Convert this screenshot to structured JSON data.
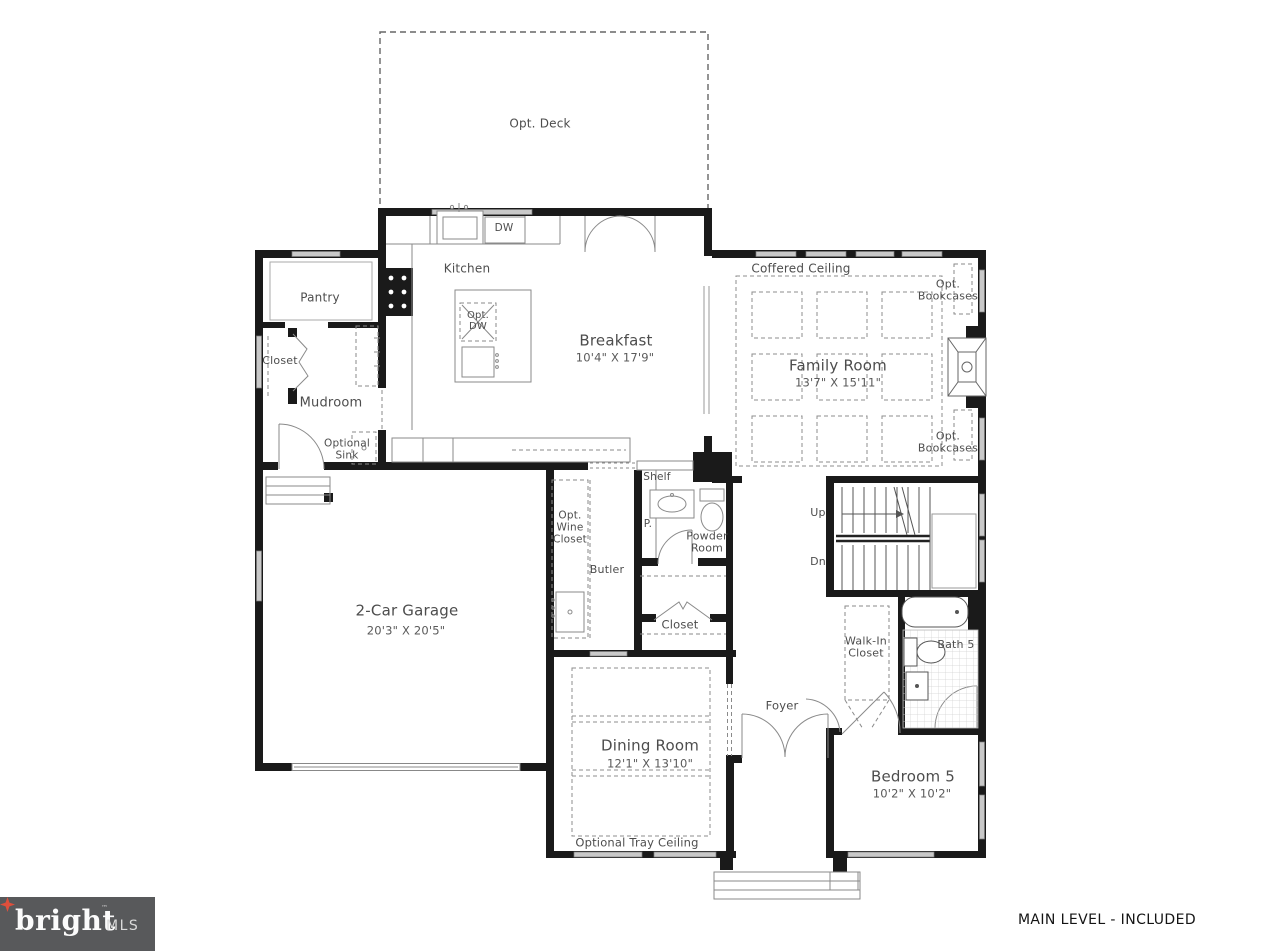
{
  "rooms": {
    "deck": {
      "label": "Opt. Deck"
    },
    "kitchen": {
      "label": "Kitchen"
    },
    "breakfast": {
      "label": "Breakfast",
      "dims": "10'4\" X 17'9\""
    },
    "family_room": {
      "label": "Family Room",
      "dims": "13'7\" X 15'11\""
    },
    "pantry": {
      "label": "Pantry"
    },
    "closet_left": {
      "label": "Closet"
    },
    "mudroom": {
      "label": "Mudroom"
    },
    "garage": {
      "label": "2-Car Garage",
      "dims": "20'3\" X 20'5\""
    },
    "butler": {
      "label": "Butler"
    },
    "wine_closet": {
      "label": "Opt. Wine Closet"
    },
    "pipe_chase": {
      "label": "P."
    },
    "powder_room": {
      "label": "Powder Room"
    },
    "closet_mid": {
      "label": "Closet"
    },
    "foyer": {
      "label": "Foyer"
    },
    "dining": {
      "label": "Dining Room",
      "dims": "12'1\" X 13'10\""
    },
    "bedroom5": {
      "label": "Bedroom 5",
      "dims": "10'2\" X 10'2\""
    },
    "walk_in": {
      "label": "Walk-In Closet"
    },
    "bath5": {
      "label": "Bath 5"
    }
  },
  "annotations": {
    "coffered_ceiling": "Coffered Ceiling",
    "opt_bookcases_top": "Opt. Bookcases",
    "opt_bookcases_bottom": "Opt. Bookcases",
    "optional_sink": "Optional Sink",
    "optional_tray_ceiling": "Optional Tray Ceiling",
    "shelf": "Shelf",
    "dw": "DW",
    "opt_dw": "Opt. DW",
    "up": "Up",
    "dn": "Dn"
  },
  "footer": {
    "plan_label": "MAIN LEVEL - INCLUDED"
  },
  "branding": {
    "logo_word": "bright",
    "logo_tm": "™",
    "logo_suffix": "MLS",
    "logo_bg": "#58595B",
    "logo_star_color": "#DF4F3C"
  },
  "colors": {
    "wall": "#1a1a1a",
    "window": "#c9c9c9",
    "line": "#8a8a8a",
    "text": "#4d4d4d"
  }
}
